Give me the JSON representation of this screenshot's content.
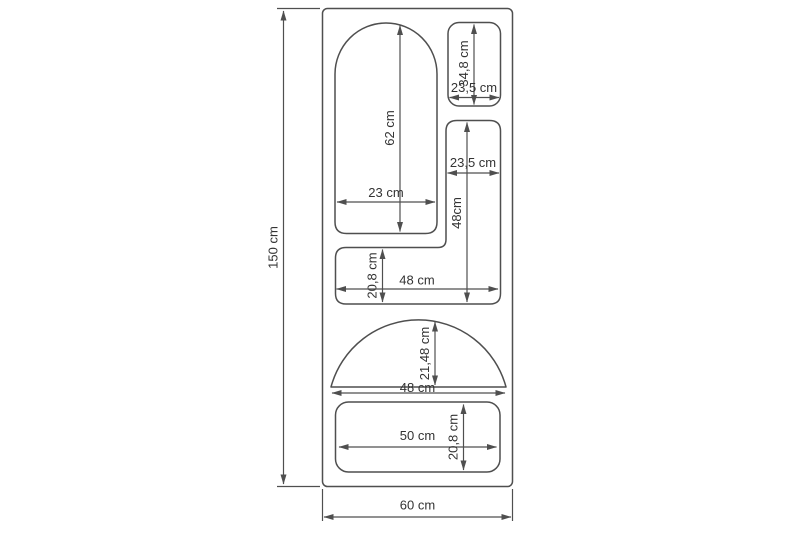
{
  "drawing": {
    "kind": "furniture-dimension-drawing",
    "overall": {
      "height": "150 cm",
      "width": "60 cm"
    },
    "compartments": {
      "arch": {
        "height": "62 cm",
        "width": "23 cm"
      },
      "top_right_niche": {
        "height": "34,8 cm",
        "width": "23,5 cm"
      },
      "right_column": {
        "width": "23,5 cm",
        "height": "48cm"
      },
      "middle_shelf": {
        "height": "20,8 cm",
        "width": "48 cm"
      },
      "dome": {
        "height": "21,48 cm",
        "width": "48 cm"
      },
      "bottom_shelf": {
        "width": "50 cm",
        "height": "20,8 cm"
      }
    }
  },
  "colors": {
    "line": "#4f4f4f",
    "text": "#333333",
    "background": "#ffffff"
  }
}
